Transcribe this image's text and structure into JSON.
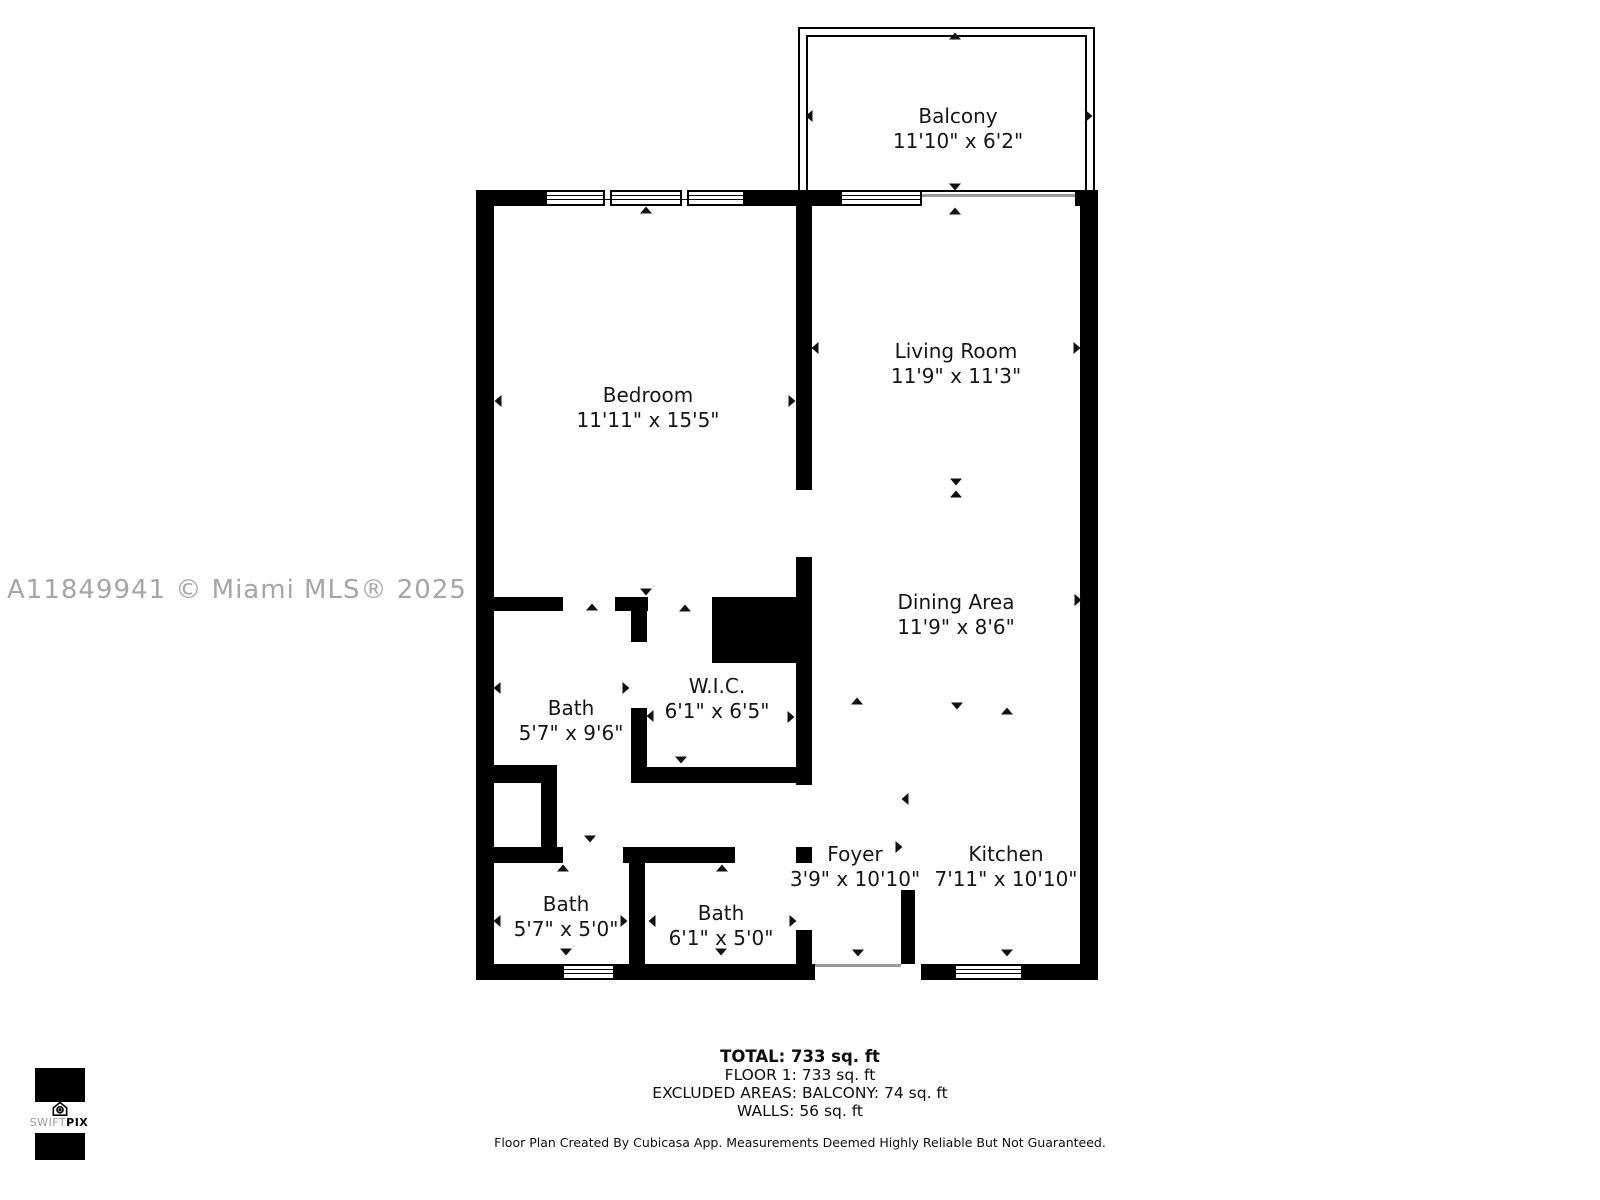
{
  "watermark": "A11849941 © Miami MLS® 2025",
  "rooms": [
    {
      "name": "Balcony",
      "dims": "11'10\" x 6'2\""
    },
    {
      "name": "Bedroom",
      "dims": "11'11\" x 15'5\""
    },
    {
      "name": "Living Room",
      "dims": "11'9\" x 11'3\""
    },
    {
      "name": "Dining Area",
      "dims": "11'9\" x 8'6\""
    },
    {
      "name": "Bath",
      "dims": "5'7\" x 9'6\""
    },
    {
      "name": "W.I.C.",
      "dims": "6'1\" x 6'5\""
    },
    {
      "name": "Bath",
      "dims": "5'7\" x 5'0\""
    },
    {
      "name": "Bath",
      "dims": "6'1\" x 5'0\""
    },
    {
      "name": "Foyer",
      "dims": "3'9\" x 10'10\""
    },
    {
      "name": "Kitchen",
      "dims": "7'11\" x 10'10\""
    }
  ],
  "summary": {
    "total": "TOTAL: 733 sq. ft",
    "floor": "FLOOR 1: 733 sq. ft",
    "excluded": "EXCLUDED AREAS: BALCONY: 74 sq. ft",
    "walls": "WALLS: 56 sq. ft"
  },
  "disclaimer": "Floor Plan Created By Cubicasa App. Measurements Deemed Highly Reliable But Not Guaranteed.",
  "logo": {
    "brand_light": "SWIFT",
    "brand_bold": "PIX"
  },
  "colors": {
    "wall": "#000000",
    "watermark": "#a6a6a6",
    "background": "#ffffff"
  }
}
